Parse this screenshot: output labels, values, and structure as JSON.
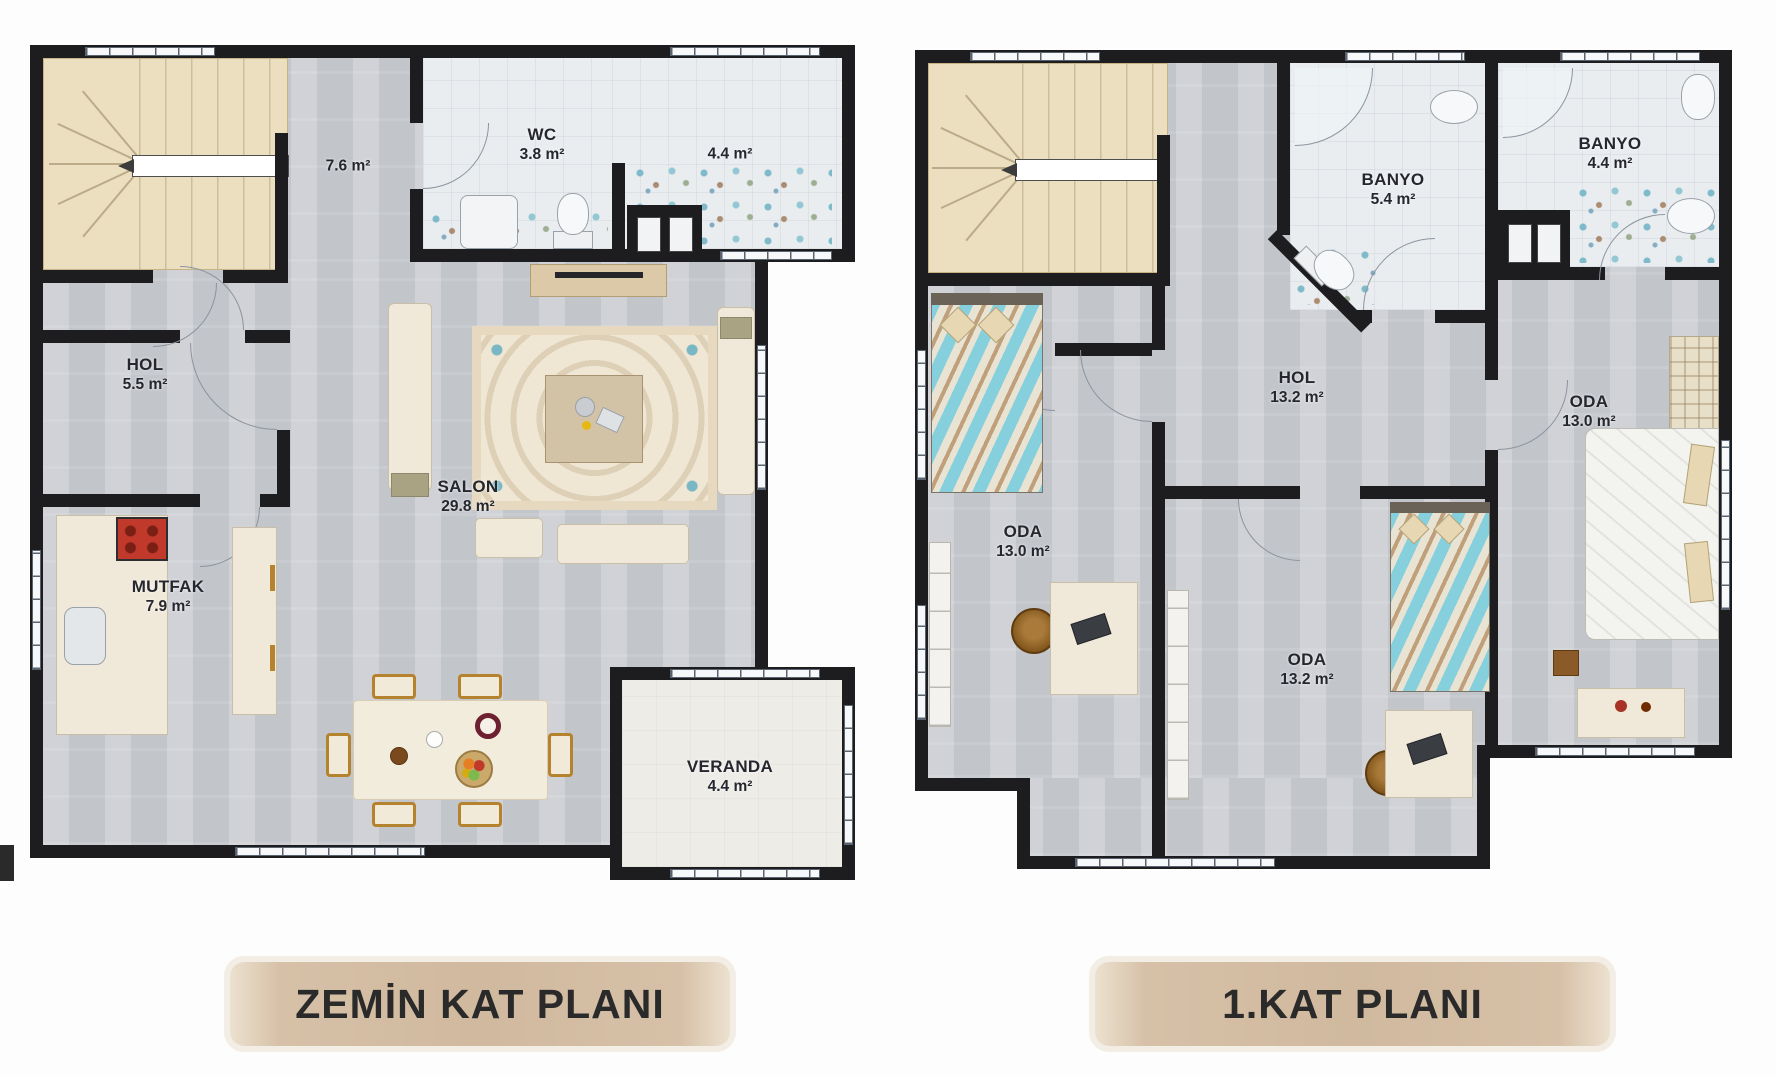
{
  "titles": {
    "ground": "ZEMİN KAT PLANI",
    "first": "1.KAT PLANI"
  },
  "ground_floor": {
    "rooms": [
      {
        "name": "",
        "area": "7.6 m²"
      },
      {
        "name": "WC",
        "area": "3.8 m²"
      },
      {
        "name": "",
        "area": "4.4 m²"
      },
      {
        "name": "HOL",
        "area": "5.5 m²"
      },
      {
        "name": "SALON",
        "area": "29.8 m²"
      },
      {
        "name": "MUTFAK",
        "area": "7.9 m²"
      },
      {
        "name": "VERANDA",
        "area": "4.4 m²"
      }
    ]
  },
  "first_floor": {
    "rooms": [
      {
        "name": "BANYO",
        "area": "5.4 m²"
      },
      {
        "name": "BANYO",
        "area": "4.4 m²"
      },
      {
        "name": "HOL",
        "area": "13.2 m²"
      },
      {
        "name": "ODA",
        "area": "13.0 m²"
      },
      {
        "name": "ODA",
        "area": "13.2 m²"
      },
      {
        "name": "ODA",
        "area": "13.0 m²"
      }
    ]
  },
  "colors": {
    "wall": "#1d1d1f",
    "floor": "#c9ccd1",
    "bathroom_floor": "#e9edf0",
    "stairs": "#ecdfc0",
    "veranda_floor": "#edece7",
    "banner": "#d0b99e",
    "accent_teal": "#85d0dc",
    "accent_wood": "#b5822e",
    "label_text": "#26262e"
  }
}
